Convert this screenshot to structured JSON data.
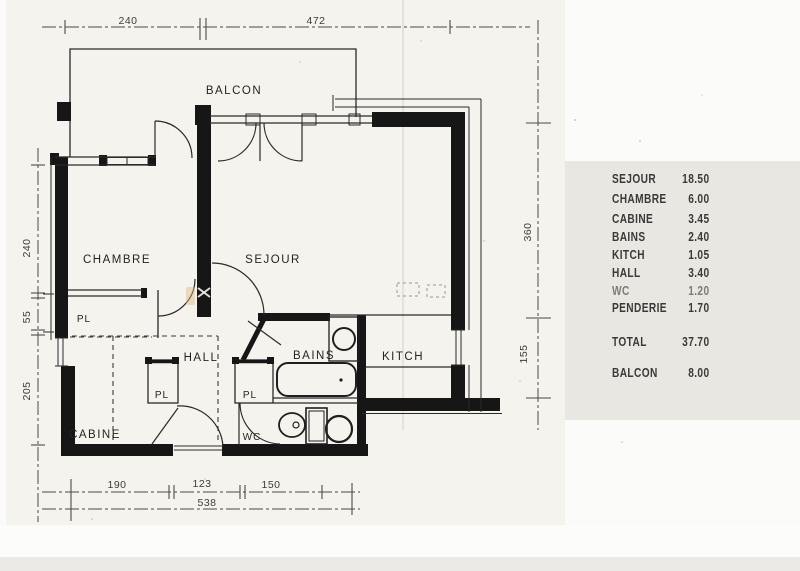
{
  "plan": {
    "rooms": {
      "balcon": "BALCON",
      "chambre": "CHAMBRE",
      "sejour": "SEJOUR",
      "hall": "HALL",
      "bains": "BAINS",
      "kitch": "KITCH",
      "wc": "WC",
      "cabine": "CABINE",
      "pl_left": "PL",
      "pl_hall": "PL",
      "pl_wc": "PL"
    },
    "dimensions": {
      "top_1": "240",
      "top_2": "472",
      "left_1": "240",
      "left_2": "55",
      "left_3": "205",
      "right_1": "360",
      "right_2": "155",
      "bottom_1": "190",
      "bottom_2": "123",
      "bottom_3": "150",
      "bottom_overall": "538"
    }
  },
  "area_table": {
    "rows": [
      {
        "label": "SEJOUR",
        "value": "18.50"
      },
      {
        "label": "CHAMBRE",
        "value": "6.00"
      },
      {
        "label": "CABINE",
        "value": "3.45"
      },
      {
        "label": "BAINS",
        "value": "2.40"
      },
      {
        "label": "KITCH",
        "value": "1.05"
      },
      {
        "label": "HALL",
        "value": "3.40"
      },
      {
        "label": "WC",
        "value": "1.20"
      },
      {
        "label": "PENDERIE",
        "value": "1.70"
      }
    ],
    "total": {
      "label": "TOTAL",
      "value": "37.70"
    },
    "balcon": {
      "label": "BALCON",
      "value": "8.00"
    }
  },
  "colors": {
    "paper": "#f5f3ee",
    "table_block": "#e9e7e2",
    "ink": "#161616",
    "highlight_smudge": "#e3b97e"
  }
}
